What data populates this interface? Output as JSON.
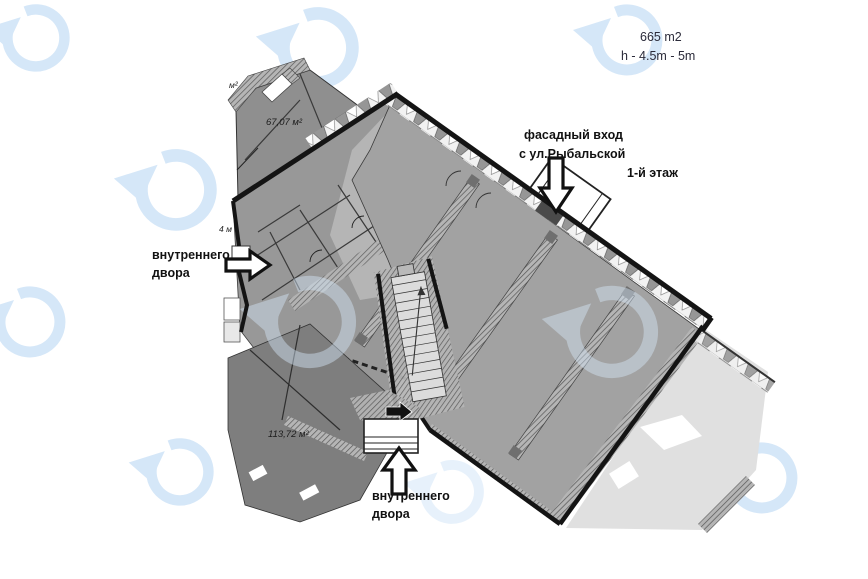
{
  "stats": {
    "area": "665  m2",
    "height": "h - 4.5m  - 5m"
  },
  "floor_label": "1-й этаж",
  "annotations": {
    "facade_entrance": {
      "line1": "фасадный вход",
      "line2": "с ул.Рыбальской"
    },
    "courtyard_left": {
      "line1": "внутреннего",
      "line2": "двора"
    },
    "courtyard_bottom": {
      "line1": "внутреннего",
      "line2": "двора"
    }
  },
  "rooms": {
    "room_a_area": "67,07 м²",
    "room_b_area": "113,72 м²",
    "corner_unit": "м²",
    "edge_dim": "4 м"
  },
  "icons": {
    "watermark": "circular-arrow-logo",
    "arrow_down": "entrance-arrow-down",
    "arrow_up": "entrance-arrow-up",
    "arrow_right": "entrance-arrow-right"
  },
  "colors": {
    "watermark_blue": "#d5e7f8",
    "boundary_black": "#141414",
    "room_dark": "#7e7e7e",
    "room_mid": "#989898",
    "hall_gray": "#a2a2a2",
    "outside_gray": "#e0e0e0",
    "stats_text": "#2b2b3a"
  }
}
